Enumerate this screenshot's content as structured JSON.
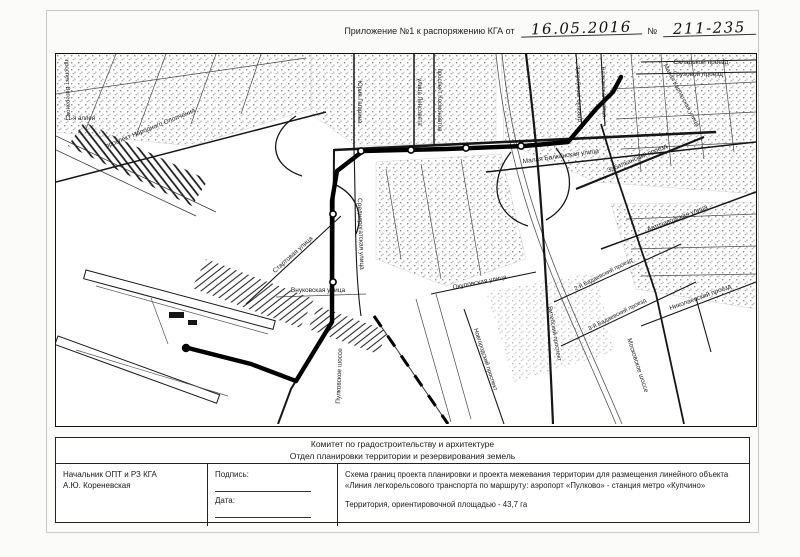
{
  "document": {
    "header": {
      "prefix": "Приложение №1 к распоряжению КГА от",
      "date": "16.05.2016",
      "number_sign": "№",
      "number": "211-235"
    },
    "title_block": {
      "org_name": "Комитет по градостроительству и архитектуре",
      "department": "Отдел планировки территории и резервирования земель",
      "official_position": "Начальник ОПТ и РЗ КГА",
      "official_name": "А.Ю. Кореневская",
      "signature_label": "Подпись:",
      "date_label": "Дата:",
      "scheme_title": "Схема границ проекта планировки и проекта межевания территории для размещения линейного объекта «Линия легкорельсового транспорта по маршруту: аэропорт «Пулково» - станция метро «Купчино»",
      "area_note": "Территория, ориентировочной площадью - 43,7 га"
    }
  },
  "map": {
    "description": "Черно-белая схема границ проекта планировки: трасса ЛРТ от аэропорта «Пулково» до станции метро «Купчино»",
    "labels": [
      {
        "text": "Складской проезд",
        "x": 645,
        "y": 10,
        "rotate": 0,
        "size": 6.5
      },
      {
        "text": "Грузовой проезд",
        "x": 642,
        "y": 22,
        "rotate": 0,
        "size": 6.5
      },
      {
        "text": "Малая Карпатская улица",
        "x": 624,
        "y": 42,
        "rotate": 62,
        "size": 6
      },
      {
        "text": "Загребский бульвар",
        "x": 521,
        "y": 40,
        "rotate": 88,
        "size": 6
      },
      {
        "text": "Балканская улица",
        "x": 546,
        "y": 38,
        "rotate": 88,
        "size": 6
      },
      {
        "text": "Малая Балканская улица",
        "x": 505,
        "y": 104,
        "rotate": -8,
        "size": 6.5
      },
      {
        "text": "Забалканский проезд",
        "x": 582,
        "y": 106,
        "rotate": -23,
        "size": 6.5
      },
      {
        "text": "Автозаводская улица",
        "x": 622,
        "y": 166,
        "rotate": -21,
        "size": 6.5
      },
      {
        "text": "проспект Космонавтов",
        "x": 382,
        "y": 46,
        "rotate": 90,
        "size": 6
      },
      {
        "text": "улица Ленсовета",
        "x": 362,
        "y": 48,
        "rotate": 90,
        "size": 6
      },
      {
        "text": "Юрия Гагарина",
        "x": 302,
        "y": 48,
        "rotate": 90,
        "size": 6
      },
      {
        "text": "Среднерогатская улица",
        "x": 303,
        "y": 180,
        "rotate": 88,
        "size": 6.5
      },
      {
        "text": "проспект Народного Ополчения",
        "x": 95,
        "y": 76,
        "rotate": -22,
        "size": 6.5
      },
      {
        "text": "11-я аллея",
        "x": 24,
        "y": 66,
        "rotate": 0,
        "size": 6
      },
      {
        "text": "проспект Ветеранов",
        "x": 10,
        "y": 34,
        "rotate": 88,
        "size": 6
      },
      {
        "text": "Пулковское шоссе",
        "x": 285,
        "y": 322,
        "rotate": -88,
        "size": 6.5
      },
      {
        "text": "Московское шоссе",
        "x": 580,
        "y": 312,
        "rotate": 72,
        "size": 6.5
      },
      {
        "text": "Внуковская улица",
        "x": 262,
        "y": 238,
        "rotate": 0,
        "size": 6.5
      },
      {
        "text": "Стартовая улица",
        "x": 238,
        "y": 202,
        "rotate": -42,
        "size": 6.5
      },
      {
        "text": "Окуловская улица",
        "x": 424,
        "y": 230,
        "rotate": -11,
        "size": 6.5
      },
      {
        "text": "Новгородский проспект",
        "x": 428,
        "y": 306,
        "rotate": 72,
        "size": 6
      },
      {
        "text": "Витебский проспект",
        "x": 497,
        "y": 280,
        "rotate": 80,
        "size": 6
      },
      {
        "text": "2-й Бадаевский проезд",
        "x": 548,
        "y": 222,
        "rotate": -27,
        "size": 6
      },
      {
        "text": "3-й Бадаевский проезд",
        "x": 562,
        "y": 262,
        "rotate": -27,
        "size": 6
      },
      {
        "text": "Николаевский проезд",
        "x": 645,
        "y": 245,
        "rotate": -20,
        "size": 6.5
      }
    ]
  },
  "colors": {
    "ink": "#1a1a1a",
    "route": "#000000",
    "paper": "#fbfbfa"
  }
}
